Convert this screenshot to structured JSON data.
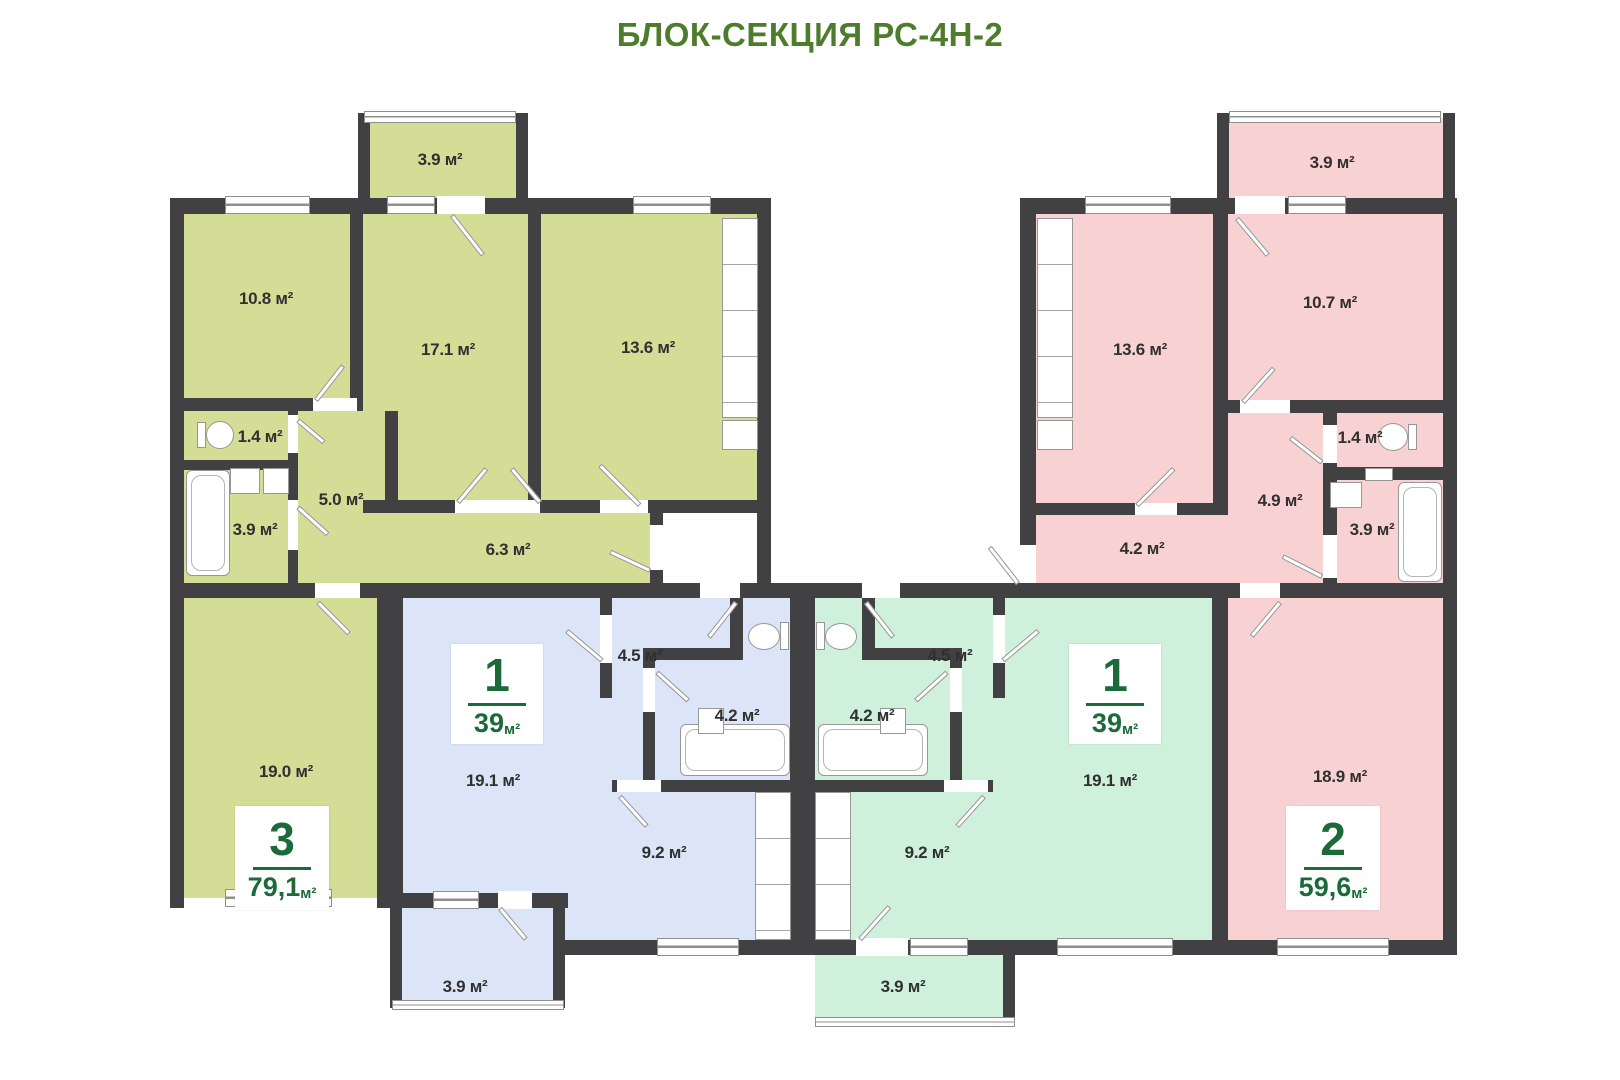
{
  "title": "БЛОК-СЕКЦИЯ РС-4Н-2",
  "apartments": {
    "a3": {
      "badge": {
        "number": "3",
        "area": "79,1",
        "unit": "м²"
      },
      "rooms": {
        "balcony": "3.9 м²",
        "room1": "10.8 м²",
        "room2": "17.1 м²",
        "kitchen": "13.6 м²",
        "wc": "1.4 м²",
        "hall": "5.0 м²",
        "bath": "3.9 м²",
        "corridor": "6.3 м²",
        "room3": "19.0 м²"
      }
    },
    "b1": {
      "badge": {
        "number": "1",
        "area": "39",
        "unit": "м²"
      },
      "rooms": {
        "hall": "4.5 м²",
        "bath": "4.2 м²",
        "living": "19.1 м²",
        "kitchen": "9.2 м²",
        "balcony": "3.9 м²"
      }
    },
    "c1": {
      "badge": {
        "number": "1",
        "area": "39",
        "unit": "м²"
      },
      "rooms": {
        "hall": "4.5 м²",
        "bath": "4.2 м²",
        "living": "19.1 м²",
        "kitchen": "9.2 м²",
        "balcony": "3.9 м²"
      }
    },
    "d2": {
      "badge": {
        "number": "2",
        "area": "59,6",
        "unit": "м²"
      },
      "rooms": {
        "balcony": "3.9 м²",
        "room1": "10.7 м²",
        "kitchen": "13.6 м²",
        "wc": "1.4 м²",
        "hall": "4.9 м²",
        "corridor": "4.2 м²",
        "bath": "3.9 м²",
        "living": "18.9 м²"
      }
    }
  },
  "colors": {
    "wall": "#414143",
    "olive": "#d3dd95",
    "blue": "#dbe5f7",
    "mint": "#cff0da",
    "pink": "#f8d2d3",
    "title": "#4c7c2c",
    "badge": "#1a6b39"
  }
}
